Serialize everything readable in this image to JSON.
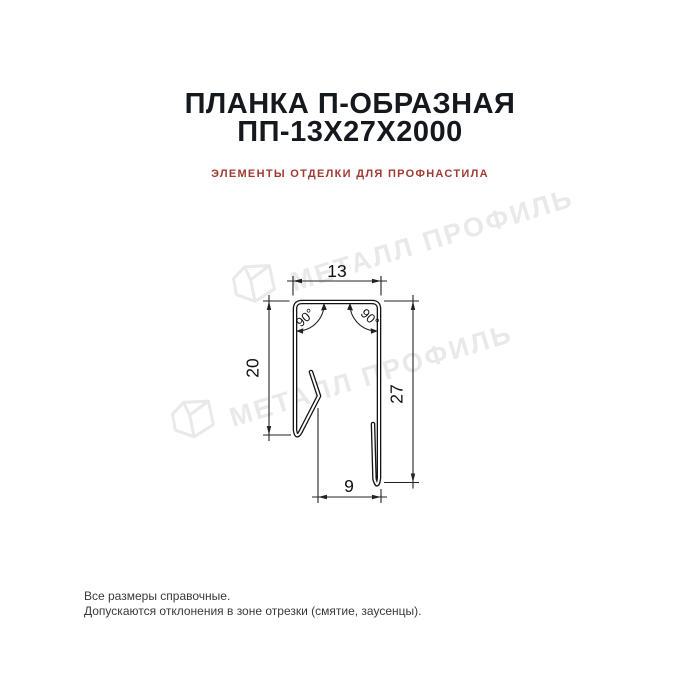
{
  "header": {
    "title_line1": "ПЛАНКА П-ОБРАЗНАЯ",
    "title_line2": "ПП-13Х27Х2000",
    "subtitle": "ЭЛЕМЕНТЫ ОТДЕЛКИ ДЛЯ ПРОФНАСТИЛА"
  },
  "drawing": {
    "dim_top_width": "13",
    "dim_left_height": "20",
    "dim_right_height": "27",
    "dim_bottom_width": "9",
    "angle_left": "90°",
    "angle_right": "90°"
  },
  "watermark": {
    "text": "МЕТАЛЛ ПРОФИЛЬ",
    "color": "#e9e9e9"
  },
  "footer": {
    "line1": "Все размеры справочные.",
    "line2": "Допускаются отклонения в зоне отрезки (смятие, заусенцы)."
  },
  "colors": {
    "title": "#15181d",
    "subtitle": "#9e3b32",
    "line": "#141414",
    "dimension": "#222222"
  }
}
